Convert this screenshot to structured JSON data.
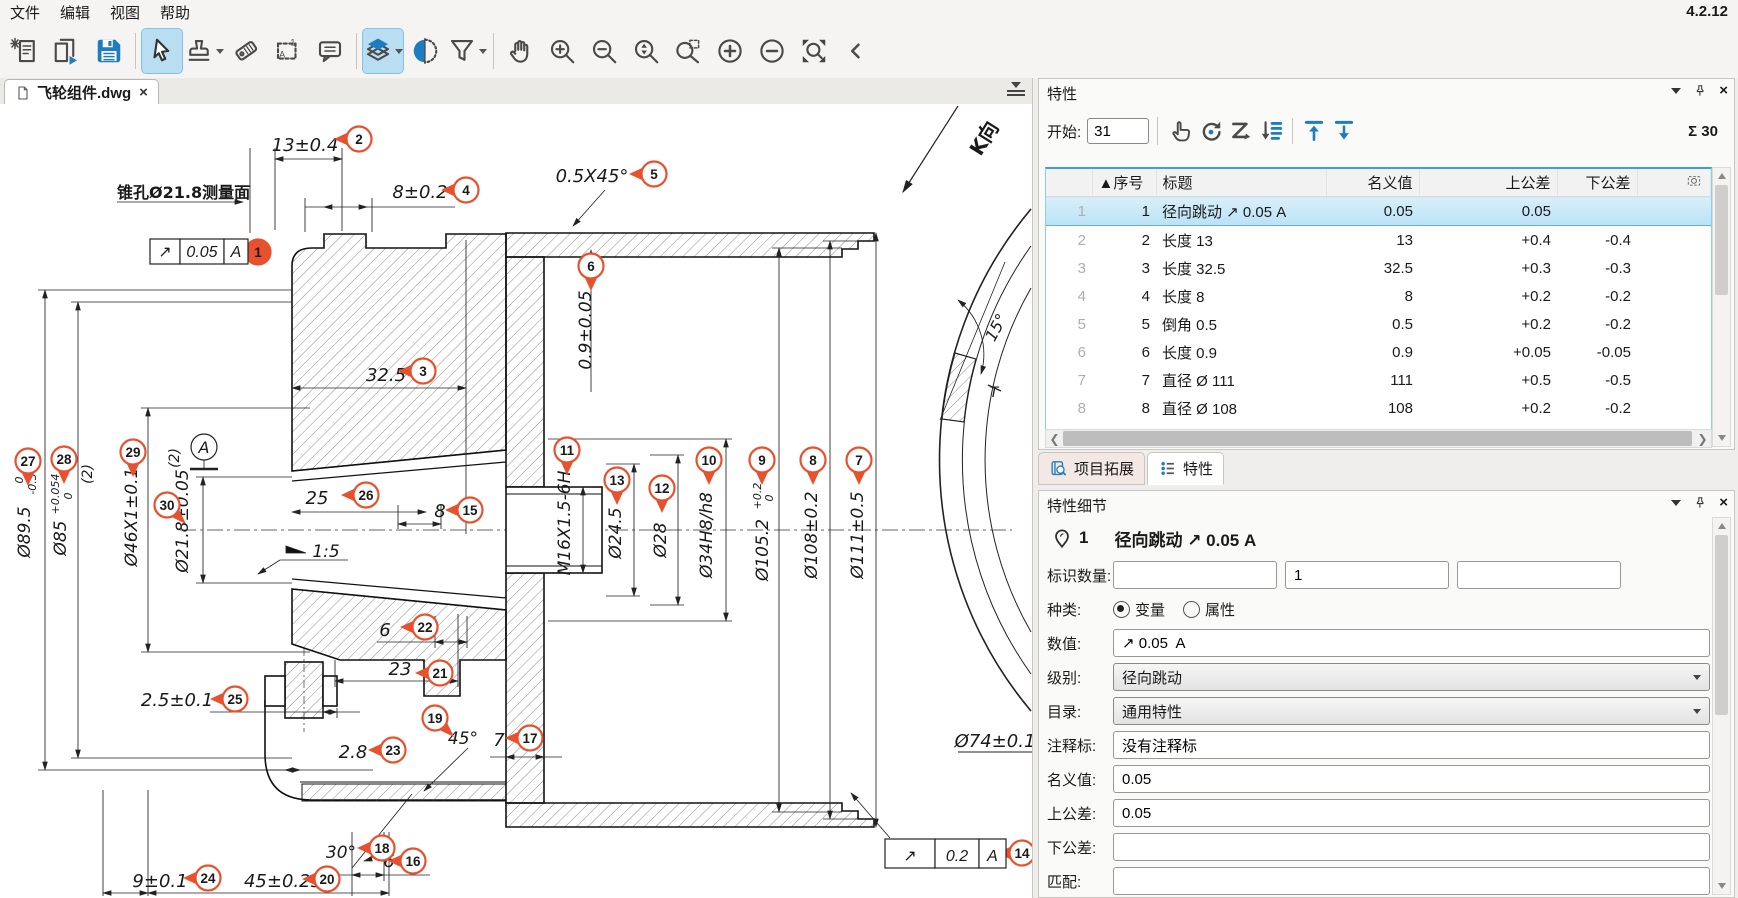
{
  "app": {
    "version": "4.2.12"
  },
  "menu": {
    "items": [
      "文件",
      "编辑",
      "视图",
      "帮助"
    ]
  },
  "toolbar": {
    "groups": [
      [
        {
          "icon": "new-document"
        },
        {
          "icon": "open-document"
        },
        {
          "icon": "save"
        }
      ],
      [
        {
          "icon": "select-cursor",
          "active": true
        },
        {
          "icon": "stamp",
          "dropdown": true
        },
        {
          "icon": "tag"
        },
        {
          "icon": "region-select"
        },
        {
          "icon": "comment"
        }
      ],
      [
        {
          "icon": "layers",
          "active": true,
          "dropdown": true
        },
        {
          "icon": "section-view"
        },
        {
          "icon": "filter",
          "dropdown": true
        }
      ],
      [
        {
          "icon": "pan-hand"
        },
        {
          "icon": "zoom-in"
        },
        {
          "icon": "zoom-out"
        },
        {
          "icon": "zoom-range"
        },
        {
          "icon": "zoom-window"
        },
        {
          "icon": "increase"
        },
        {
          "icon": "decrease"
        },
        {
          "icon": "zoom-fit"
        },
        {
          "icon": "collapse"
        }
      ]
    ]
  },
  "document": {
    "tab_label": "飞轮组件.dwg",
    "close_label": "×"
  },
  "drawing": {
    "balloon_color": "#e8512d",
    "balloons": [
      {
        "n": "1",
        "x": 258,
        "y": 252,
        "dir": "L",
        "filled": true
      },
      {
        "n": "2",
        "x": 359,
        "y": 139,
        "dir": "L"
      },
      {
        "n": "3",
        "x": 423,
        "y": 371,
        "dir": "L"
      },
      {
        "n": "4",
        "x": 466,
        "y": 190,
        "dir": "L"
      },
      {
        "n": "5",
        "x": 654,
        "y": 174,
        "dir": "L"
      },
      {
        "n": "6",
        "x": 591,
        "y": 266,
        "dir": "D"
      },
      {
        "n": "7",
        "x": 859,
        "y": 460,
        "dir": "D"
      },
      {
        "n": "8",
        "x": 813,
        "y": 460,
        "dir": "D"
      },
      {
        "n": "9",
        "x": 762,
        "y": 460,
        "dir": "D"
      },
      {
        "n": "10",
        "x": 709,
        "y": 460,
        "dir": "D"
      },
      {
        "n": "11",
        "x": 567,
        "y": 450,
        "dir": "D"
      },
      {
        "n": "12",
        "x": 662,
        "y": 488,
        "dir": "D"
      },
      {
        "n": "13",
        "x": 617,
        "y": 480,
        "dir": "D"
      },
      {
        "n": "14",
        "x": 1022,
        "y": 853,
        "dir": "L"
      },
      {
        "n": "15",
        "x": 470,
        "y": 510,
        "dir": "L"
      },
      {
        "n": "16",
        "x": 413,
        "y": 861,
        "dir": "L"
      },
      {
        "n": "17",
        "x": 530,
        "y": 738,
        "dir": "L"
      },
      {
        "n": "18",
        "x": 382,
        "y": 848,
        "dir": "L"
      },
      {
        "n": "19",
        "x": 435,
        "y": 718,
        "dir": "DR"
      },
      {
        "n": "20",
        "x": 327,
        "y": 879,
        "dir": "L"
      },
      {
        "n": "21",
        "x": 440,
        "y": 673,
        "dir": "L"
      },
      {
        "n": "22",
        "x": 425,
        "y": 627,
        "dir": "L"
      },
      {
        "n": "23",
        "x": 393,
        "y": 750,
        "dir": "L"
      },
      {
        "n": "24",
        "x": 208,
        "y": 878,
        "dir": "L"
      },
      {
        "n": "25",
        "x": 235,
        "y": 699,
        "dir": "L"
      },
      {
        "n": "26",
        "x": 366,
        "y": 495,
        "dir": "L"
      },
      {
        "n": "27",
        "x": 28,
        "y": 461,
        "dir": "D"
      },
      {
        "n": "28",
        "x": 64,
        "y": 459,
        "dir": "D"
      },
      {
        "n": "29",
        "x": 133,
        "y": 452,
        "dir": "D"
      },
      {
        "n": "30",
        "x": 167,
        "y": 505,
        "dir": "DR"
      }
    ],
    "labels": [
      {
        "t": "锥孔Ø21.8测量面",
        "x": 117,
        "y": 198,
        "s": 16,
        "b": 1
      },
      {
        "t": "13±0.4",
        "x": 305,
        "y": 151,
        "s": 18,
        "i": 1,
        "a": "m"
      },
      {
        "t": "8±0.2",
        "x": 420,
        "y": 198,
        "s": 18,
        "i": 1,
        "a": "m"
      },
      {
        "t": "0.5X45°",
        "x": 592,
        "y": 182,
        "s": 18,
        "i": 1,
        "a": "m"
      },
      {
        "t": "32.5",
        "x": 386,
        "y": 381,
        "s": 18,
        "i": 1,
        "a": "m"
      },
      {
        "t": "25",
        "x": 317,
        "y": 504,
        "s": 18,
        "i": 1,
        "a": "m"
      },
      {
        "t": "8",
        "x": 440,
        "y": 517,
        "s": 18,
        "i": 1,
        "a": "m"
      },
      {
        "t": "1:5",
        "x": 326,
        "y": 557,
        "s": 17,
        "i": 1,
        "a": "m"
      },
      {
        "t": "6",
        "x": 385,
        "y": 636,
        "s": 18,
        "i": 1,
        "a": "m"
      },
      {
        "t": "23",
        "x": 400,
        "y": 675,
        "s": 18,
        "i": 1,
        "a": "m"
      },
      {
        "t": "2.5±0.1",
        "x": 177,
        "y": 706,
        "s": 18,
        "i": 1,
        "a": "m"
      },
      {
        "t": "2.8",
        "x": 353,
        "y": 758,
        "s": 18,
        "i": 1,
        "a": "m"
      },
      {
        "t": "45°",
        "x": 463,
        "y": 744,
        "s": 17,
        "i": 1,
        "a": "m"
      },
      {
        "t": "7",
        "x": 499,
        "y": 746,
        "s": 18,
        "i": 1,
        "a": "m"
      },
      {
        "t": "30°",
        "x": 341,
        "y": 858,
        "s": 17,
        "i": 1,
        "a": "m"
      },
      {
        "t": "6",
        "x": 389,
        "y": 867,
        "s": 18,
        "i": 1,
        "a": "m"
      },
      {
        "t": "9±0.1",
        "x": 160,
        "y": 887,
        "s": 18,
        "i": 1,
        "a": "m"
      },
      {
        "t": "45±0.25",
        "x": 283,
        "y": 887,
        "s": 18,
        "i": 1,
        "a": "m"
      },
      {
        "t": "Ø74±0.1",
        "x": 995,
        "y": 747,
        "s": 18,
        "i": 1,
        "a": "m"
      },
      {
        "t": "0.9±0.05",
        "x": 591,
        "y": 330,
        "s": 17,
        "i": 1,
        "a": "m",
        "r": -90
      },
      {
        "t": "M16X1.5-6H",
        "x": 570,
        "y": 523,
        "s": 17,
        "i": 1,
        "a": "m",
        "r": -90
      },
      {
        "t": "Ø24.5",
        "x": 621,
        "y": 533,
        "s": 17,
        "i": 1,
        "a": "m",
        "r": -90
      },
      {
        "t": "Ø28",
        "x": 666,
        "y": 540,
        "s": 17,
        "i": 1,
        "a": "m",
        "r": -90
      },
      {
        "t": "Ø34H8/h8",
        "x": 712,
        "y": 535,
        "s": 17,
        "i": 1,
        "a": "m",
        "r": -90
      },
      {
        "t": "Ø105.2",
        "x": 768,
        "y": 550,
        "s": 17,
        "i": 1,
        "a": "m",
        "r": -90
      },
      {
        "t": "+0.2",
        "x": 761,
        "y": 496,
        "s": 11,
        "i": 1,
        "a": "m",
        "r": -90
      },
      {
        "t": "0",
        "x": 773,
        "y": 498,
        "s": 11,
        "i": 1,
        "a": "m",
        "r": -90
      },
      {
        "t": "Ø108±0.2",
        "x": 817,
        "y": 535,
        "s": 17,
        "i": 1,
        "a": "m",
        "r": -90
      },
      {
        "t": "Ø111±0.5",
        "x": 863,
        "y": 535,
        "s": 17,
        "i": 1,
        "a": "m",
        "r": -90
      },
      {
        "t": "Ø89.5",
        "x": 30,
        "y": 532,
        "s": 17,
        "i": 1,
        "a": "m",
        "r": -90
      },
      {
        "t": "0",
        "x": 23,
        "y": 480,
        "s": 11,
        "i": 1,
        "a": "m",
        "r": -90
      },
      {
        "t": "-0.3",
        "x": 36,
        "y": 484,
        "s": 11,
        "i": 1,
        "a": "m",
        "r": -90
      },
      {
        "t": "Ø85",
        "x": 66,
        "y": 538,
        "s": 17,
        "i": 1,
        "a": "m",
        "r": -90
      },
      {
        "t": "+0.054",
        "x": 59,
        "y": 494,
        "s": 11,
        "i": 1,
        "a": "m",
        "r": -90
      },
      {
        "t": "0",
        "x": 72,
        "y": 496,
        "s": 11,
        "i": 1,
        "a": "m",
        "r": -90
      },
      {
        "t": "(2)",
        "x": 92,
        "y": 474,
        "s": 14,
        "i": 1,
        "a": "m",
        "r": -90
      },
      {
        "t": "Ø46X1±0.1",
        "x": 137,
        "y": 517,
        "s": 17,
        "i": 1,
        "a": "m",
        "r": -90
      },
      {
        "t": "(2)",
        "x": 179,
        "y": 458,
        "s": 14,
        "i": 1,
        "a": "m",
        "r": -90
      },
      {
        "t": "Ø21.8±0.05",
        "x": 188,
        "y": 521,
        "s": 17,
        "i": 1,
        "a": "m",
        "r": -90
      },
      {
        "t": "A",
        "x": 204,
        "y": 453,
        "s": 16,
        "i": 1,
        "a": "m"
      },
      {
        "t": "15°",
        "x": 1001,
        "y": 330,
        "s": 16,
        "i": 1,
        "a": "m",
        "r": -62
      },
      {
        "t": "K向",
        "x": 990,
        "y": 142,
        "s": 20,
        "b": 1,
        "a": "m",
        "r": -58
      },
      {
        "t": "T",
        "x": 994,
        "y": 397,
        "s": 14,
        "i": 1,
        "a": "m"
      }
    ],
    "fcf": [
      {
        "x": 150,
        "y": 239,
        "h": 25,
        "cells": [
          {
            "t": "↗",
            "w": 30
          },
          {
            "t": "0.05",
            "w": 44
          },
          {
            "t": "A",
            "w": 24
          }
        ]
      },
      {
        "x": 885,
        "y": 839,
        "h": 29,
        "cells": [
          {
            "t": "↗",
            "w": 50
          },
          {
            "t": "0.2",
            "w": 44
          },
          {
            "t": "A",
            "w": 27
          }
        ]
      }
    ]
  },
  "properties_panel": {
    "title": "特性",
    "start_label": "开始:",
    "start_value": "31",
    "sum_label": "Σ 30",
    "tools": [
      "hand-point",
      "rotate",
      "zorder",
      "sortlist",
      "up-bar",
      "down-bar"
    ],
    "table": {
      "columns": [
        "▲序号",
        "标题",
        "名义值",
        "上公差",
        "下公差"
      ],
      "rows": [
        {
          "idx": "1",
          "no": "1",
          "title": "径向跳动 ↗ 0.05 A",
          "nominal": "0.05",
          "upper": "0.05",
          "lower": "",
          "selected": true
        },
        {
          "idx": "2",
          "no": "2",
          "title": "长度 13",
          "nominal": "13",
          "upper": "+0.4",
          "lower": "-0.4"
        },
        {
          "idx": "3",
          "no": "3",
          "title": "长度 32.5",
          "nominal": "32.5",
          "upper": "+0.3",
          "lower": "-0.3"
        },
        {
          "idx": "4",
          "no": "4",
          "title": "长度 8",
          "nominal": "8",
          "upper": "+0.2",
          "lower": "-0.2"
        },
        {
          "idx": "5",
          "no": "5",
          "title": "倒角 0.5",
          "nominal": "0.5",
          "upper": "+0.2",
          "lower": "-0.2"
        },
        {
          "idx": "6",
          "no": "6",
          "title": "长度 0.9",
          "nominal": "0.9",
          "upper": "+0.05",
          "lower": "-0.05"
        },
        {
          "idx": "7",
          "no": "7",
          "title": "直径 Ø 111",
          "nominal": "111",
          "upper": "+0.5",
          "lower": "-0.5"
        },
        {
          "idx": "8",
          "no": "8",
          "title": "直径 Ø 108",
          "nominal": "108",
          "upper": "+0.2",
          "lower": "-0.2"
        }
      ]
    },
    "tabs": [
      {
        "label": "项目拓展",
        "icon": "book-search",
        "active": false
      },
      {
        "label": "特性",
        "icon": "list-blue",
        "active": true
      }
    ]
  },
  "details_panel": {
    "title": "特性细节",
    "item_number": "1",
    "item_title": "径向跳动 ↗ 0.05 A",
    "fields": {
      "id_count_label": "标识数量:",
      "id_count_values": [
        "",
        "1",
        ""
      ],
      "kind_label": "种类:",
      "kind_options": [
        {
          "label": "变量",
          "checked": true
        },
        {
          "label": "属性",
          "checked": false
        }
      ],
      "value_label": "数值:",
      "value": "↗ 0.05  A",
      "level_label": "级别:",
      "level": "径向跳动",
      "catalog_label": "目录:",
      "catalog": "通用特性",
      "note_label": "注释标:",
      "note": "没有注释标",
      "nominal_label": "名义值:",
      "nominal": "0.05",
      "upper_label": "上公差:",
      "upper": "0.05",
      "lower_label": "下公差:",
      "lower": "",
      "match_label": "匹配:",
      "match": ""
    }
  }
}
